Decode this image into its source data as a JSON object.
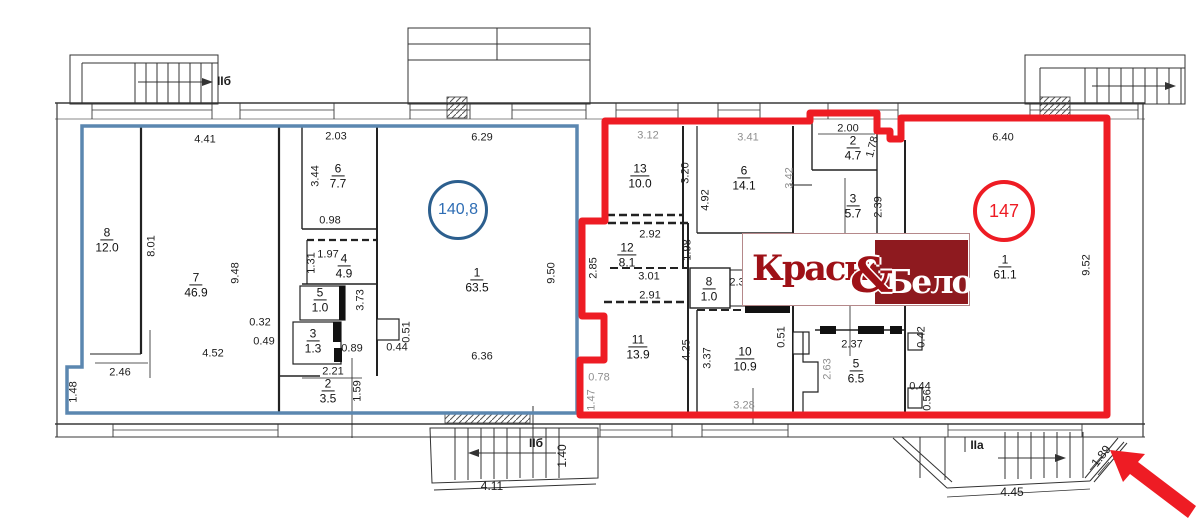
{
  "colors": {
    "blue_outline": "#5b87b0",
    "blue_dark": "#2c5f8e",
    "blue_text": "#2e6db4",
    "red_outline": "#ee1c24",
    "logo_maroon": "#8e1a1f",
    "logo_red": "#9e1117",
    "dim_text": "#1c1c1c",
    "dim_muted": "#8f8f8f",
    "line": "#3a3a3a"
  },
  "zones": {
    "blue": {
      "area_label": "140,8"
    },
    "red": {
      "area_label": "147"
    }
  },
  "logo": {
    "left_word": "Красное",
    "ampersand": "&",
    "right_word": "Белое"
  },
  "rooms": [
    {
      "n": "8",
      "a": "12.0",
      "x": 107,
      "y": 240
    },
    {
      "n": "7",
      "a": "46.9",
      "x": 196,
      "y": 285
    },
    {
      "n": "6",
      "a": "7.7",
      "x": 338,
      "y": 176
    },
    {
      "n": "4",
      "a": "4.9",
      "x": 344,
      "y": 266
    },
    {
      "n": "5",
      "a": "1.0",
      "x": 320,
      "y": 300
    },
    {
      "n": "3",
      "a": "1.3",
      "x": 313,
      "y": 341
    },
    {
      "n": "2",
      "a": "3.5",
      "x": 328,
      "y": 391
    },
    {
      "n": "1",
      "a": "63.5",
      "x": 477,
      "y": 280
    },
    {
      "n": "13",
      "a": "10.0",
      "x": 640,
      "y": 176
    },
    {
      "n": "6",
      "a": "14.1",
      "x": 744,
      "y": 178
    },
    {
      "n": "2",
      "a": "4.7",
      "x": 853,
      "y": 148
    },
    {
      "n": "3",
      "a": "5.7",
      "x": 853,
      "y": 206
    },
    {
      "n": "12",
      "a": "8.1",
      "x": 627,
      "y": 255
    },
    {
      "n": "8",
      "a": "1.0",
      "x": 709,
      "y": 289
    },
    {
      "n": "11",
      "a": "13.9",
      "x": 638,
      "y": 347
    },
    {
      "n": "10",
      "a": "10.9",
      "x": 745,
      "y": 359
    },
    {
      "n": "5",
      "a": "6.5",
      "x": 856,
      "y": 371
    },
    {
      "n": "1",
      "a": "61.1",
      "x": 1005,
      "y": 267
    }
  ],
  "dim_labels": [
    {
      "t": "4.41",
      "x": 205,
      "y": 140
    },
    {
      "t": "2.03",
      "x": 336,
      "y": 137
    },
    {
      "t": "6.29",
      "x": 482,
      "y": 138
    },
    {
      "t": "3.44",
      "x": 316,
      "y": 176,
      "r": -90
    },
    {
      "t": "0.98",
      "x": 330,
      "y": 221
    },
    {
      "t": "8.01",
      "x": 152,
      "y": 246,
      "r": -90
    },
    {
      "t": "9.48",
      "x": 236,
      "y": 273,
      "r": -90
    },
    {
      "t": "1.97",
      "x": 328,
      "y": 255
    },
    {
      "t": "1.31",
      "x": 312,
      "y": 263,
      "r": -90
    },
    {
      "t": "3.73",
      "x": 361,
      "y": 300,
      "r": -90
    },
    {
      "t": "0.32",
      "x": 260,
      "y": 323
    },
    {
      "t": "0.49",
      "x": 264,
      "y": 342
    },
    {
      "t": "0.51",
      "x": 407,
      "y": 332,
      "r": -90
    },
    {
      "t": "0.44",
      "x": 397,
      "y": 348
    },
    {
      "t": "0.89",
      "x": 352,
      "y": 349
    },
    {
      "t": "2.21",
      "x": 333,
      "y": 372
    },
    {
      "t": "1.59",
      "x": 358,
      "y": 391,
      "r": -90
    },
    {
      "t": "4.52",
      "x": 213,
      "y": 354
    },
    {
      "t": "2.46",
      "x": 120,
      "y": 373
    },
    {
      "t": "1.48",
      "x": 74,
      "y": 392,
      "r": -90
    },
    {
      "t": "9.50",
      "x": 552,
      "y": 273,
      "r": -90
    },
    {
      "t": "6.36",
      "x": 482,
      "y": 357
    },
    {
      "t": "3.12",
      "x": 648,
      "y": 136,
      "m": 1
    },
    {
      "t": "3.41",
      "x": 748,
      "y": 138,
      "m": 1
    },
    {
      "t": "2.00",
      "x": 848,
      "y": 129
    },
    {
      "t": "1.78",
      "x": 873,
      "y": 147,
      "r": -75
    },
    {
      "t": "3.20",
      "x": 686,
      "y": 173,
      "r": -90
    },
    {
      "t": "3.42",
      "x": 790,
      "y": 178,
      "r": -90,
      "m": 1
    },
    {
      "t": "4.92",
      "x": 706,
      "y": 200,
      "r": -90
    },
    {
      "t": "2.39",
      "x": 879,
      "y": 207,
      "r": -90
    },
    {
      "t": "2.92",
      "x": 650,
      "y": 235
    },
    {
      "t": "1.98",
      "x": 688,
      "y": 250,
      "r": -90
    },
    {
      "t": "2.85",
      "x": 594,
      "y": 268,
      "r": -90
    },
    {
      "t": "3.01",
      "x": 649,
      "y": 277
    },
    {
      "t": "2.91",
      "x": 650,
      "y": 296
    },
    {
      "t": "2.3",
      "x": 737,
      "y": 283
    },
    {
      "t": "0.78",
      "x": 599,
      "y": 378,
      "m": 1
    },
    {
      "t": "1.47",
      "x": 592,
      "y": 400,
      "r": -90,
      "m": 1
    },
    {
      "t": "4.25",
      "x": 687,
      "y": 350,
      "r": -90
    },
    {
      "t": "3.37",
      "x": 708,
      "y": 358,
      "r": -90
    },
    {
      "t": "0.51",
      "x": 782,
      "y": 337,
      "r": -90
    },
    {
      "t": "3.28",
      "x": 744,
      "y": 406,
      "m": 1
    },
    {
      "t": "2.37",
      "x": 852,
      "y": 345
    },
    {
      "t": "2.63",
      "x": 828,
      "y": 369,
      "r": -90,
      "m": 1
    },
    {
      "t": "0.42",
      "x": 922,
      "y": 337,
      "r": -90
    },
    {
      "t": "0.44",
      "x": 920,
      "y": 387
    },
    {
      "t": "0.56",
      "x": 928,
      "y": 400,
      "r": -90
    },
    {
      "t": "6.40",
      "x": 1003,
      "y": 138
    },
    {
      "t": "9.52",
      "x": 1087,
      "y": 265,
      "r": -90
    },
    {
      "t": "IIб",
      "x": 224,
      "y": 81,
      "b": 1
    },
    {
      "t": "IIб",
      "x": 536,
      "y": 443,
      "b": 1
    },
    {
      "t": "1.40",
      "x": 562,
      "y": 456,
      "r": -90,
      "s": 12
    },
    {
      "t": "4.11",
      "x": 492,
      "y": 486,
      "s": 12
    },
    {
      "t": "IIa",
      "x": 977,
      "y": 445,
      "b": 1
    },
    {
      "t": "4.45",
      "x": 1012,
      "y": 492,
      "s": 12
    },
    {
      "t": "1.89",
      "x": 1101,
      "y": 456,
      "r": -52,
      "s": 12
    }
  ]
}
